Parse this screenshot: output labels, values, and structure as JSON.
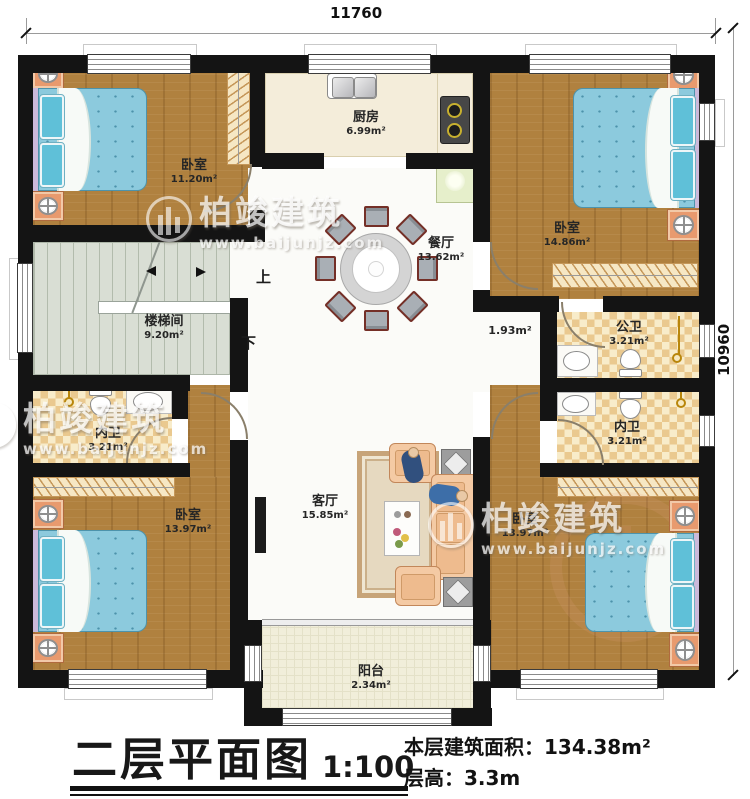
{
  "plan": {
    "dimension_top": "11760",
    "dimension_right": "10960",
    "stairs": {
      "up": "上",
      "down": "下"
    },
    "corridor_width": "1.93m²",
    "rooms": {
      "bedroom_top_left": {
        "name": "卧室",
        "area": "11.20m²"
      },
      "kitchen": {
        "name": "厨房",
        "area": "6.99m²"
      },
      "bedroom_top_right": {
        "name": "卧室",
        "area": "14.86m²"
      },
      "dining_room": {
        "name": "餐厅",
        "area": "13.62m²"
      },
      "stairwell": {
        "name": "楼梯间",
        "area": "9.20m²"
      },
      "public_bathroom": {
        "name": "公卫",
        "area": "3.21m²"
      },
      "ensuite_left": {
        "name": "内卫",
        "area": "3.21m²"
      },
      "ensuite_right": {
        "name": "内卫",
        "area": "3.21m²"
      },
      "bedroom_bottom_left": {
        "name": "卧室",
        "area": "13.97m²"
      },
      "living_room": {
        "name": "客厅",
        "area": "15.85m²"
      },
      "bedroom_bottom_right": {
        "name": "卧室",
        "area": "13.97m²"
      },
      "balcony": {
        "name": "阳台",
        "area": "2.34m²"
      }
    }
  },
  "title_block": {
    "title": "二层平面图",
    "scale": "1:100",
    "floor_area_label": "本层建筑面积：",
    "floor_area_value": "134.38m²",
    "floor_height_label": "层高：",
    "floor_height_value": "3.3m"
  },
  "watermark": {
    "brand": "柏竣建筑",
    "url": "www.baijunjz.com"
  },
  "colors": {
    "wall": "#141414",
    "wood": "#b0813f",
    "bath_tile": "#eac98f",
    "mattress": "#8ccadd",
    "accent": "#e89a6e"
  }
}
